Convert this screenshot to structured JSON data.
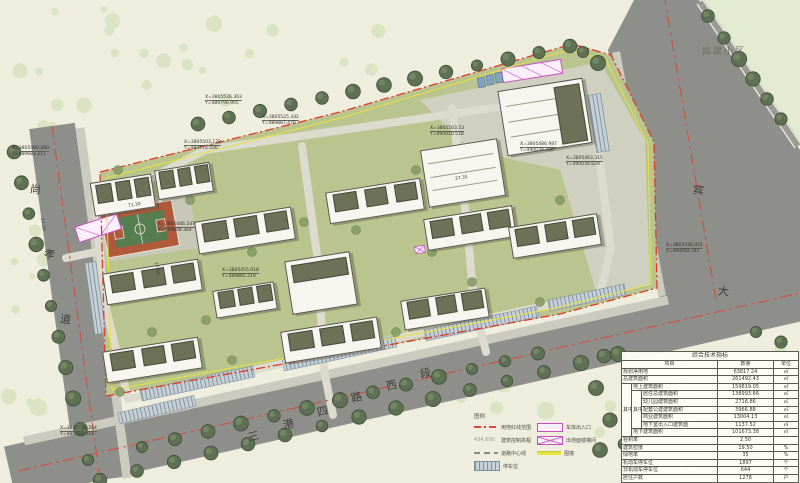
{
  "drawing": {
    "planned_area_label": "拟建小区",
    "colors": {
      "boundary_red": "#dd3b2c",
      "fence_yellow": "#e6e33f",
      "garage_magenta": "#c84fc0",
      "road_gray": "#8e8f8a",
      "site_green": "#b9c48e",
      "street_tree_green": "#5e7154",
      "court_orange": "#b0593b"
    },
    "roads": [
      {
        "name": "尚孝道",
        "chars": [
          {
            "c": "尚",
            "x": 30,
            "y": 181,
            "r": 8
          },
          {
            "c": "孝",
            "x": 44,
            "y": 246,
            "r": 8
          },
          {
            "c": "道",
            "x": 60,
            "y": 311,
            "r": 8
          }
        ]
      },
      {
        "name": "三港四路西段",
        "chars": [
          {
            "c": "三",
            "x": 248,
            "y": 428,
            "r": -13
          },
          {
            "c": "港",
            "x": 283,
            "y": 416,
            "r": -13
          },
          {
            "c": "四",
            "x": 317,
            "y": 403,
            "r": -13
          },
          {
            "c": "路",
            "x": 351,
            "y": 389,
            "r": -13
          },
          {
            "c": "西",
            "x": 386,
            "y": 377,
            "r": -13
          },
          {
            "c": "段",
            "x": 420,
            "y": 365,
            "r": -13
          }
        ]
      },
      {
        "name": "宾大道",
        "chars": [
          {
            "c": "宾",
            "x": 693,
            "y": 182,
            "r": 6
          },
          {
            "c": "大",
            "x": 718,
            "y": 283,
            "r": 6
          }
        ]
      }
    ],
    "coordinate_labels": [
      {
        "x": 12,
        "y": 146,
        "l1": "X=3805480.460",
        "l2": "Y=489683.211"
      },
      {
        "x": 205,
        "y": 95,
        "l1": "X=3805536.363",
        "l2": "Y=489796.905"
      },
      {
        "x": 262,
        "y": 115,
        "l1": "X=3805525.342",
        "l2": "Y=489887.470"
      },
      {
        "x": 184,
        "y": 140,
        "l1": "X=3805503.178",
        "l2": "Y=489773.500"
      },
      {
        "x": 430,
        "y": 126,
        "l1": "X=3805503.53",
        "l2": "Y=490010.518"
      },
      {
        "x": 520,
        "y": 142,
        "l1": "X=3805486.987",
        "l2": "Y=490039.706"
      },
      {
        "x": 566,
        "y": 156,
        "l1": "X=3805463.315",
        "l2": "Y=490039.829"
      },
      {
        "x": 666,
        "y": 243,
        "l1": "X=3805436.051",
        "l2": "Y=490092.341"
      },
      {
        "x": 158,
        "y": 222,
        "l1": "X=3805446.547",
        "l2": "Y=489808.364"
      },
      {
        "x": 222,
        "y": 268,
        "l1": "X=3805455.018",
        "l2": "Y=489885.219"
      },
      {
        "x": 60,
        "y": 426,
        "l1": "X=3805536.264",
        "l2": "Y=489721.011"
      }
    ],
    "dimension_labels": [
      {
        "t": "37.35",
        "x": 455,
        "y": 176,
        "r": -9
      },
      {
        "t": "24.00",
        "x": 36,
        "y": 222,
        "r": 82
      },
      {
        "t": "71.30",
        "x": 128,
        "y": 203,
        "r": -9
      },
      {
        "t": "17.50",
        "x": 150,
        "y": 266,
        "r": 80
      }
    ],
    "buildings": [
      {
        "x": 92,
        "y": 178,
        "w": 60,
        "h": 32,
        "t": "res"
      },
      {
        "x": 156,
        "y": 166,
        "w": 54,
        "h": 28,
        "t": "res"
      },
      {
        "x": 196,
        "y": 214,
        "w": 96,
        "h": 31,
        "t": "res"
      },
      {
        "x": 104,
        "y": 266,
        "w": 95,
        "h": 30,
        "t": "res"
      },
      {
        "x": 104,
        "y": 344,
        "w": 95,
        "h": 30,
        "t": "res"
      },
      {
        "x": 288,
        "y": 256,
        "w": 64,
        "h": 52,
        "t": "block"
      },
      {
        "x": 327,
        "y": 185,
        "w": 94,
        "h": 30,
        "t": "res"
      },
      {
        "x": 425,
        "y": 212,
        "w": 88,
        "h": 30,
        "t": "res"
      },
      {
        "x": 510,
        "y": 220,
        "w": 88,
        "h": 30,
        "t": "res"
      },
      {
        "x": 282,
        "y": 324,
        "w": 96,
        "h": 30,
        "t": "res"
      },
      {
        "x": 402,
        "y": 294,
        "w": 84,
        "h": 28,
        "t": "res"
      },
      {
        "x": 214,
        "y": 286,
        "w": 60,
        "h": 26,
        "t": "res"
      },
      {
        "x": 424,
        "y": 144,
        "w": 76,
        "h": 56,
        "t": "kg"
      },
      {
        "x": 502,
        "y": 84,
        "w": 84,
        "h": 64,
        "t": "com"
      }
    ]
  },
  "legend": {
    "title": "图例",
    "items": [
      {
        "swatch": "redline",
        "label": "用地红线范围",
        "col": 1
      },
      {
        "swatch": "elev",
        "label": "建筑控制高程",
        "sample": "434.600",
        "col": 1
      },
      {
        "swatch": "centerline",
        "label": "道路中心线",
        "col": 1
      },
      {
        "swatch": "parking",
        "label": "停车位",
        "col": 1
      },
      {
        "swatch": "garage",
        "label": "车库出入口",
        "col": 2
      },
      {
        "swatch": "stair",
        "label": "出地面楼梯间",
        "col": 2
      },
      {
        "swatch": "wall",
        "label": "围墙",
        "col": 2
      }
    ]
  },
  "table": {
    "title": "综合技术指标",
    "headers": [
      "项目",
      "数量",
      "单位"
    ],
    "among_label": "其中",
    "rows": [
      {
        "label": "规划净用地",
        "value": "63817.24",
        "unit": "㎡",
        "indent": 0
      },
      {
        "label": "总建筑面积",
        "value": "261492.43",
        "unit": "㎡",
        "indent": 0
      },
      {
        "label": "地上建筑面积",
        "value": "159819.05",
        "unit": "㎡",
        "indent": 1
      },
      {
        "label": "居住总建筑面积",
        "value": "138993.66",
        "unit": "㎡",
        "indent": 2
      },
      {
        "label": "幼儿园建筑面积",
        "value": "2716.86",
        "unit": "㎡",
        "indent": 2
      },
      {
        "label": "配套公建建筑面积",
        "value": "3966.88",
        "unit": "㎡",
        "indent": 2
      },
      {
        "label": "商业建筑面积",
        "value": "13004.13",
        "unit": "㎡",
        "indent": 2
      },
      {
        "label": "地下室出入口建筑面",
        "value": "1137.52",
        "unit": "㎡",
        "indent": 2
      },
      {
        "label": "地下建筑面积",
        "value": "101673.38",
        "unit": "㎡",
        "indent": 1
      },
      {
        "label": "容积率",
        "value": "2.50",
        "unit": "",
        "indent": 0
      },
      {
        "label": "建筑密度",
        "value": "19.50",
        "unit": "%",
        "indent": 0
      },
      {
        "label": "绿地率",
        "value": "35",
        "unit": "%",
        "indent": 0
      },
      {
        "label": "机动车停车位",
        "value": "1897",
        "unit": "个",
        "indent": 0
      },
      {
        "label": "非机动车停车位",
        "value": "644",
        "unit": "个",
        "indent": 0
      },
      {
        "label": "居住户数",
        "value": "1278",
        "unit": "户",
        "indent": 0
      }
    ]
  }
}
